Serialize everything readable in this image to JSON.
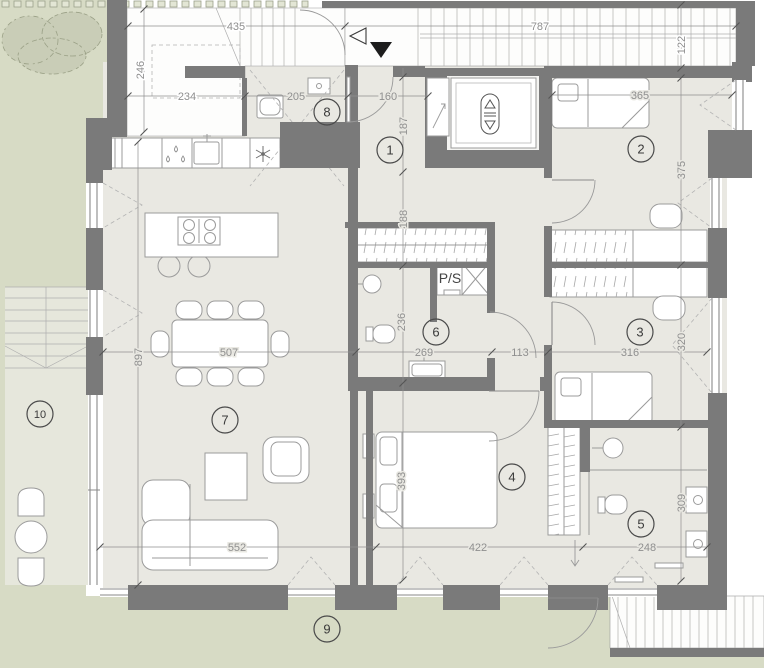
{
  "floorplan": {
    "colors": {
      "wall": "#7a7a7a",
      "floor": "#e9e8e2",
      "garden": "#d7dbc5",
      "dim_text": "#8f8f8f"
    },
    "room_numbers": {
      "r1": "1",
      "r2": "2",
      "r3": "3",
      "r4": "4",
      "r5": "5",
      "r6": "6",
      "r7": "7",
      "r8": "8",
      "r9": "9",
      "r10": "10"
    },
    "labels": {
      "shaft": "P/S"
    },
    "icons": {
      "stair_direction": "filled-down-triangle",
      "stair_entry": "outline-left-triangle",
      "elevator_control": "up-down-arrows",
      "fridge": "snowflake",
      "dishwasher": "water-drops"
    },
    "dims": {
      "d435": "435",
      "d787": "787",
      "d122": "122",
      "d246": "246",
      "d234": "234",
      "d205": "205",
      "d160": "160",
      "d365": "365",
      "d375": "375",
      "d187": "187",
      "d188": "188",
      "d236": "236",
      "d393": "393",
      "d897": "897",
      "d507": "507",
      "d269": "269",
      "d113": "113",
      "d316": "316",
      "d320": "320",
      "d309": "309",
      "d552": "552",
      "d422": "422",
      "d248": "248"
    }
  }
}
